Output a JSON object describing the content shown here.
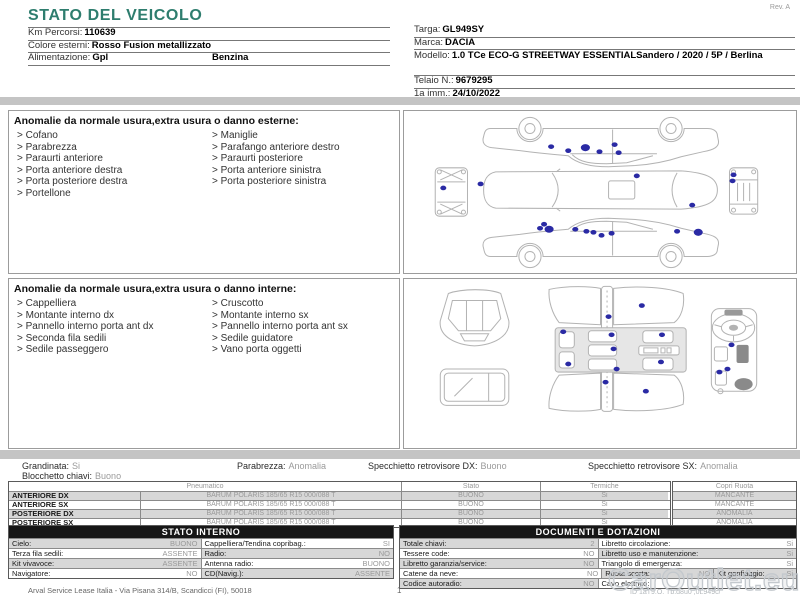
{
  "page": {
    "title": "STATO DEL VEICOLO",
    "rev": "Rev. A",
    "watermark": "CarOutlet.eu"
  },
  "colors": {
    "accent_teal": "#2e7d6e",
    "damage_marker": "#2a2aa4",
    "bar_grey": "#c4c4c4",
    "row_grey": "#d7d7d7"
  },
  "vehicle": {
    "left": [
      {
        "label": "Km Percorsi:",
        "value": "110639",
        "value2": ""
      },
      {
        "label": "Colore esterni:",
        "value": "Rosso Fusion metallizzato",
        "value2": ""
      },
      {
        "label": "Alimentazione:",
        "value": "Gpl",
        "value2": "Benzina"
      }
    ],
    "right": [
      {
        "label": "Targa:",
        "value": "GL949SY"
      },
      {
        "label": "Marca:",
        "value": "DACIA"
      },
      {
        "label": "Modello:",
        "value": "1.0 TCe ECO-G STREETWAY ESSENTIALSandero / 2020 / 5P / Berlina"
      },
      {
        "label": "Telaio N.:",
        "value": "9679295"
      },
      {
        "label": "1a imm.:",
        "value": "24/10/2022"
      }
    ]
  },
  "exterior": {
    "heading": "Anomalie da normale usura,extra usura o danno esterne:",
    "items_left": [
      "Cofano",
      "Parabrezza",
      "Paraurti anteriore",
      "Porta anteriore destra",
      "Porta posteriore destra",
      "Portellone"
    ],
    "items_right": [
      "Maniglie",
      "Parafango anteriore destro",
      "Paraurti posteriore",
      "Porta anteriore sinistra",
      "Porta posteriore sinistra"
    ]
  },
  "interior": {
    "heading": "Anomalie da normale usura,extra usura o danno interne:",
    "items_left": [
      "Cappelliera",
      "Montante interno dx",
      "Pannello interno porta ant dx",
      "Seconda fila sedili",
      "Sedile passeggero"
    ],
    "items_right": [
      "Cruscotto",
      "Montante interno sx",
      "Pannello interno porta ant sx",
      "Sedile guidatore",
      "Vano porta oggetti"
    ]
  },
  "diagrams": {
    "exterior_markers": [
      [
        39,
        76
      ],
      [
        146,
        35
      ],
      [
        163,
        39
      ],
      [
        180,
        36,
        4.5,
        3.5
      ],
      [
        194,
        40
      ],
      [
        209,
        33
      ],
      [
        213,
        41
      ],
      [
        76,
        72
      ],
      [
        231,
        64
      ],
      [
        286,
        93
      ],
      [
        135,
        116
      ],
      [
        139,
        112
      ],
      [
        144,
        117,
        4.5,
        3.5
      ],
      [
        170,
        117
      ],
      [
        181,
        119
      ],
      [
        188,
        120
      ],
      [
        196,
        123
      ],
      [
        206,
        121
      ],
      [
        271,
        119
      ],
      [
        292,
        120,
        4.5,
        3.5
      ],
      [
        327,
        63
      ],
      [
        326,
        69
      ]
    ],
    "interior_markers": [
      [
        203,
        36
      ],
      [
        236,
        25
      ],
      [
        158,
        51
      ],
      [
        206,
        54
      ],
      [
        256,
        54
      ],
      [
        208,
        68
      ],
      [
        163,
        83
      ],
      [
        255,
        81
      ],
      [
        211,
        88
      ],
      [
        200,
        101
      ],
      [
        240,
        110
      ],
      [
        325,
        64
      ],
      [
        313,
        91
      ],
      [
        321,
        88
      ]
    ]
  },
  "summary": {
    "items": [
      {
        "label": "Grandinata:",
        "value": "Si"
      },
      {
        "label": "Parabrezza:",
        "value": "Anomalia"
      },
      {
        "label": "Specchietto retrovisore DX:",
        "value": "Buono"
      },
      {
        "label": "Specchietto retrovisore SX:",
        "value": "Anomalia"
      }
    ],
    "second_line": {
      "label": "Blocchetto chiavi:",
      "value": "Buono"
    }
  },
  "tires": {
    "col_pneumatico": "Pneumatico",
    "col_stato": "Stato",
    "col_termiche": "Termiche",
    "col_copri_ruota": "Copri Ruota",
    "rows": [
      {
        "pos": "ANTERIORE DX",
        "spec": "BARUM POLARIS 185/65 R15 000/088 T",
        "stato": "BUONO",
        "termiche": "Si",
        "copri": "MANCANTE"
      },
      {
        "pos": "ANTERIORE SX",
        "spec": "BARUM POLARIS 185/65 R15 000/088 T",
        "stato": "BUONO",
        "termiche": "Si",
        "copri": "MANCANTE"
      },
      {
        "pos": "POSTERIORE DX",
        "spec": "BARUM POLARIS 185/65 R15 000/088 T",
        "stato": "BUONO",
        "termiche": "Si",
        "copri": "ANOMALIA"
      },
      {
        "pos": "POSTERIORE SX",
        "spec": "BARUM POLARIS 185/65 R15 000/088 T",
        "stato": "BUONO",
        "termiche": "Si",
        "copri": "ANOMALIA"
      }
    ]
  },
  "stato_interno": {
    "title": "STATO INTERNO",
    "rows": [
      {
        "l_label": "Cielo:",
        "l_value": "BUONO",
        "r_label": "Cappelliera/Tendina copribag.:",
        "r_value": "SI"
      },
      {
        "l_label": "Terza fila sedili:",
        "l_value": "ASSENTE",
        "r_label": "Radio:",
        "r_value": "NO"
      },
      {
        "l_label": "Kit vivavoce:",
        "l_value": "ASSENTE",
        "r_label": "Antenna radio:",
        "r_value": "BUONO"
      },
      {
        "l_label": "Navigatore:",
        "l_value": "NO",
        "r_label": "CD(Navig.):",
        "r_value": "ASSENTE"
      }
    ]
  },
  "documenti": {
    "title": "DOCUMENTI E DOTAZIONI",
    "rows": [
      {
        "l_label": "Totale chiavi:",
        "l_value": "2",
        "r_label": "Libretto circolazione:",
        "r_value": "Si"
      },
      {
        "l_label": "Tessere code:",
        "l_value": "NO",
        "r_label": "Libretto uso e manutenzione:",
        "r_value": "Si"
      },
      {
        "l_label": "Libretto garanzia/service:",
        "l_value": "NO",
        "r_label": "Triangolo di emergenza:",
        "r_value": "Si"
      },
      {
        "l_label": "Catene da neve:",
        "l_value": "NO",
        "r_label": "Ruota scorta:",
        "r_value": "NO",
        "r2_label": "Kit gonfiaggio:",
        "r2_value": "Si"
      },
      {
        "l_label": "Codice autoradio:",
        "l_value": "NO",
        "r_label": "Cavo elettrico:",
        "r_value": ""
      }
    ]
  },
  "footer": {
    "company": "Arval Service Lease Italia - Via Pisana 314/B, Scandicci (FI), 50018",
    "page": "1",
    "doc_id": "ID 1aT9.O. Tb.d8u0 ,0L949c/"
  }
}
